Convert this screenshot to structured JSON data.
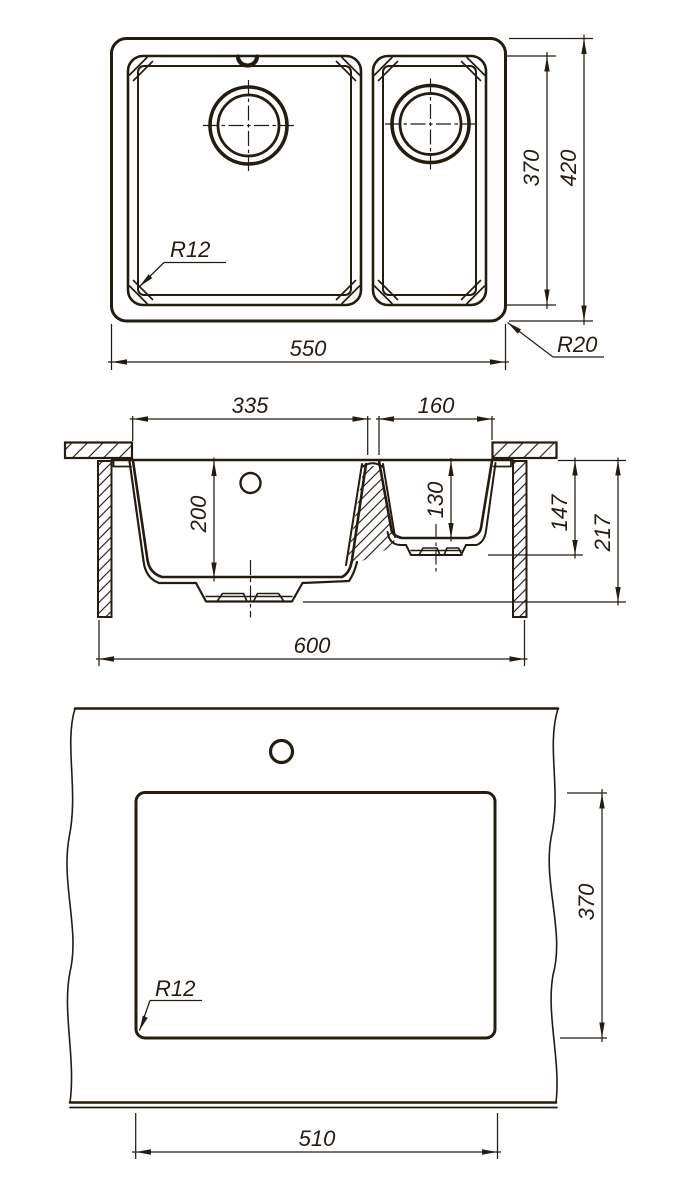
{
  "page": {
    "background": "#ffffff",
    "ink": "#241c11",
    "description": "Dimensioned technical drawing of a one-and-a-half bowl kitchen sink: plan view, cross-section and worktop cut-out template"
  },
  "top_view": {
    "dim_width": "550",
    "dim_height": "420",
    "dim_bowl_span": "370",
    "label_inner_radius": "R12",
    "label_outer_radius": "R20"
  },
  "section_view": {
    "dim_main_bowl_width": "335",
    "dim_small_bowl_width": "160",
    "dim_main_bowl_depth": "200",
    "dim_small_bowl_depth": "130",
    "dim_under_height": "147",
    "dim_total_depth": "217",
    "dim_cabinet_width": "600"
  },
  "cutout_view": {
    "dim_cutout_depth": "370",
    "dim_cutout_width": "510",
    "label_corner_radius": "R12"
  }
}
